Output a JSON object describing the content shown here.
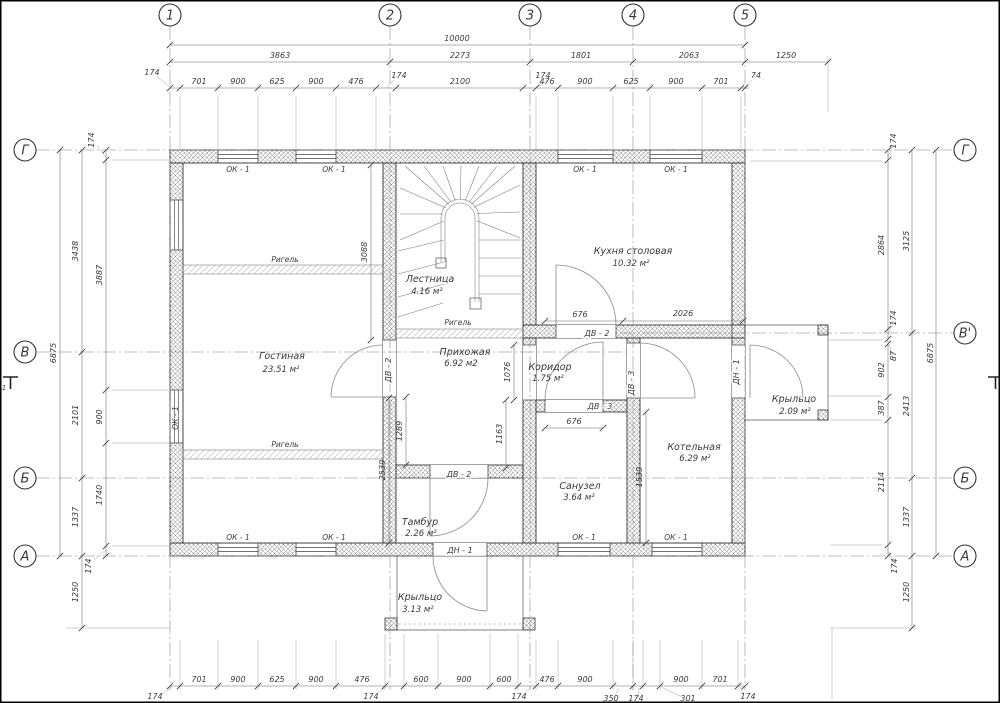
{
  "axis_circles": {
    "top": [
      "1",
      "2",
      "3",
      "4",
      "5"
    ],
    "left": [
      "Г",
      "В",
      "Б",
      "А"
    ],
    "right": [
      "Г",
      "В'",
      "Б",
      "А"
    ]
  },
  "section_marks": {
    "left": "1",
    "right": "1"
  },
  "dimensions": {
    "top": {
      "overall": "10000",
      "spans": [
        "3863",
        "2273",
        "1801",
        "2063",
        "1250"
      ],
      "fine": [
        "701",
        "900",
        "625",
        "900",
        "476",
        "2100",
        "476",
        "900",
        "625",
        "900",
        "701"
      ],
      "leaders": [
        "174",
        "174",
        "174",
        "74"
      ]
    },
    "bottom": {
      "fine": [
        "701",
        "900",
        "625",
        "900",
        "476",
        "600",
        "900",
        "600",
        "476",
        "900",
        "900",
        "701"
      ],
      "leaders": [
        "174",
        "174",
        "174",
        "350",
        "174",
        "301",
        "174"
      ]
    },
    "left": {
      "overall": "6875",
      "spans": [
        "3438",
        "2101",
        "1337",
        "1250"
      ],
      "fine": [
        "174",
        "3887",
        "900",
        "1740",
        "174"
      ]
    },
    "right": {
      "overall": "6875",
      "spans": [
        "3125",
        "2413",
        "1337",
        "1250"
      ],
      "fine": [
        "174",
        "2864",
        "174",
        "87",
        "902",
        "387",
        "2114",
        "174"
      ]
    },
    "interior": {
      "gostinaya_height": "3088",
      "axis2_lower": "2539",
      "hall_left": "1289",
      "hall_right": "1163",
      "corridor_opening": "1076",
      "kitchen_door": "676",
      "kitchen_width": "2026",
      "bath_door": "676",
      "boiler_height": "1539"
    }
  },
  "rooms": {
    "living": {
      "name": "Гостиная",
      "area": "23.51 м²"
    },
    "stairs": {
      "name": "Лестница",
      "area": "4.16 м²"
    },
    "hall": {
      "name": "Прихожая",
      "area": "6.92 м2"
    },
    "kitchen": {
      "name": "Кухня столовая",
      "area": "10.32 м²"
    },
    "corridor": {
      "name": "Коридор",
      "area": "1.75 м²"
    },
    "bathroom": {
      "name": "Санузел",
      "area": "3.64 м²"
    },
    "vestibule": {
      "name": "Тамбур",
      "area": "2.26 м²"
    },
    "boiler": {
      "name": "Котельная",
      "area": "6.29 м²"
    },
    "porch_right": {
      "name": "Крыльцо",
      "area": "2.09 м²"
    },
    "porch_bottom": {
      "name": "Крыльцо",
      "area": "3.13 м²"
    }
  },
  "tags": {
    "beam": "Ригель",
    "window": "ОК - 1",
    "door_int_2": "ДВ - 2",
    "door_int_3": "ДВ - 3",
    "door_ext": "ДН - 1"
  }
}
